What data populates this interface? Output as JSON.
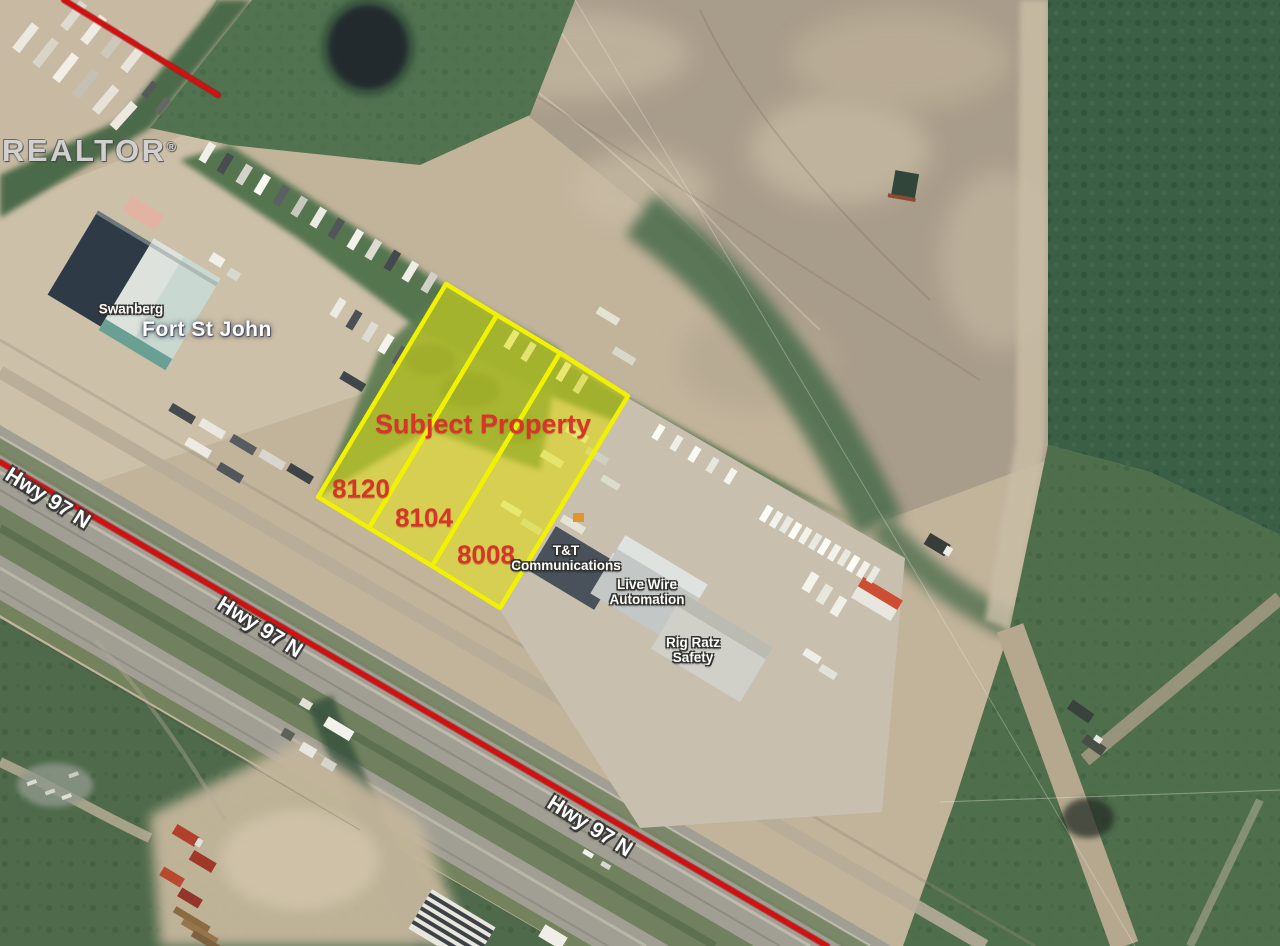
{
  "map": {
    "watermark": {
      "brand": "REALTOR",
      "registered_mark": "®"
    },
    "city_label": "Fort St John",
    "subject_property_label": "Subject Property",
    "highway_label": "Hwy 97 N",
    "parcels": [
      {
        "address": "8120"
      },
      {
        "address": "8104"
      },
      {
        "address": "8008"
      }
    ],
    "businesses": [
      {
        "line1": "Swanberg",
        "line2": ""
      },
      {
        "line1": "T&T",
        "line2": "Communications"
      },
      {
        "line1": "Live Wire",
        "line2": "Automation"
      },
      {
        "line1": "Rig Ratz",
        "line2": "Safety"
      }
    ],
    "colors": {
      "parcel_fill": "#e8e800",
      "parcel_stroke": "#f2f200",
      "highway_line": "#d01111",
      "annotation_red": "#d8352a",
      "label_white": "#ffffff"
    }
  }
}
